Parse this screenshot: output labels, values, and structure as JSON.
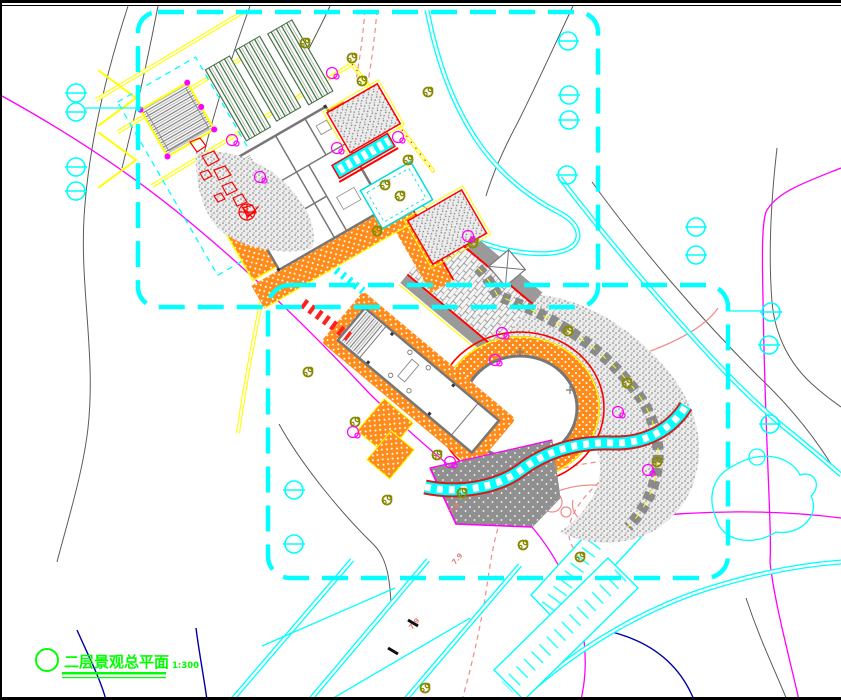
{
  "drawing": {
    "title": "二层景观总平面",
    "scale_label": "1:300",
    "elevation_labels": [
      "7.9",
      "7.9",
      "7.9"
    ]
  },
  "palette": {
    "boundary_cyan": "#00ffff",
    "road_cyan": "#00ffff",
    "contour_gray": "#5a5a5a",
    "contour_magenta": "#ff00ff",
    "contour_blue": "#0000a8",
    "contour_pink": "#f08b8b",
    "paving_orange": "#ff8c1a",
    "stone_stipple_gray": "#8c8c8c",
    "terrace_dark_gray": "#909090",
    "planting_green": "#2e6b2e",
    "accent_red": "#ff0000",
    "accent_yellow": "#ffff00",
    "tree_olive": "#8a8a00",
    "title_green": "#00ff00",
    "frame_black": "#000000"
  }
}
